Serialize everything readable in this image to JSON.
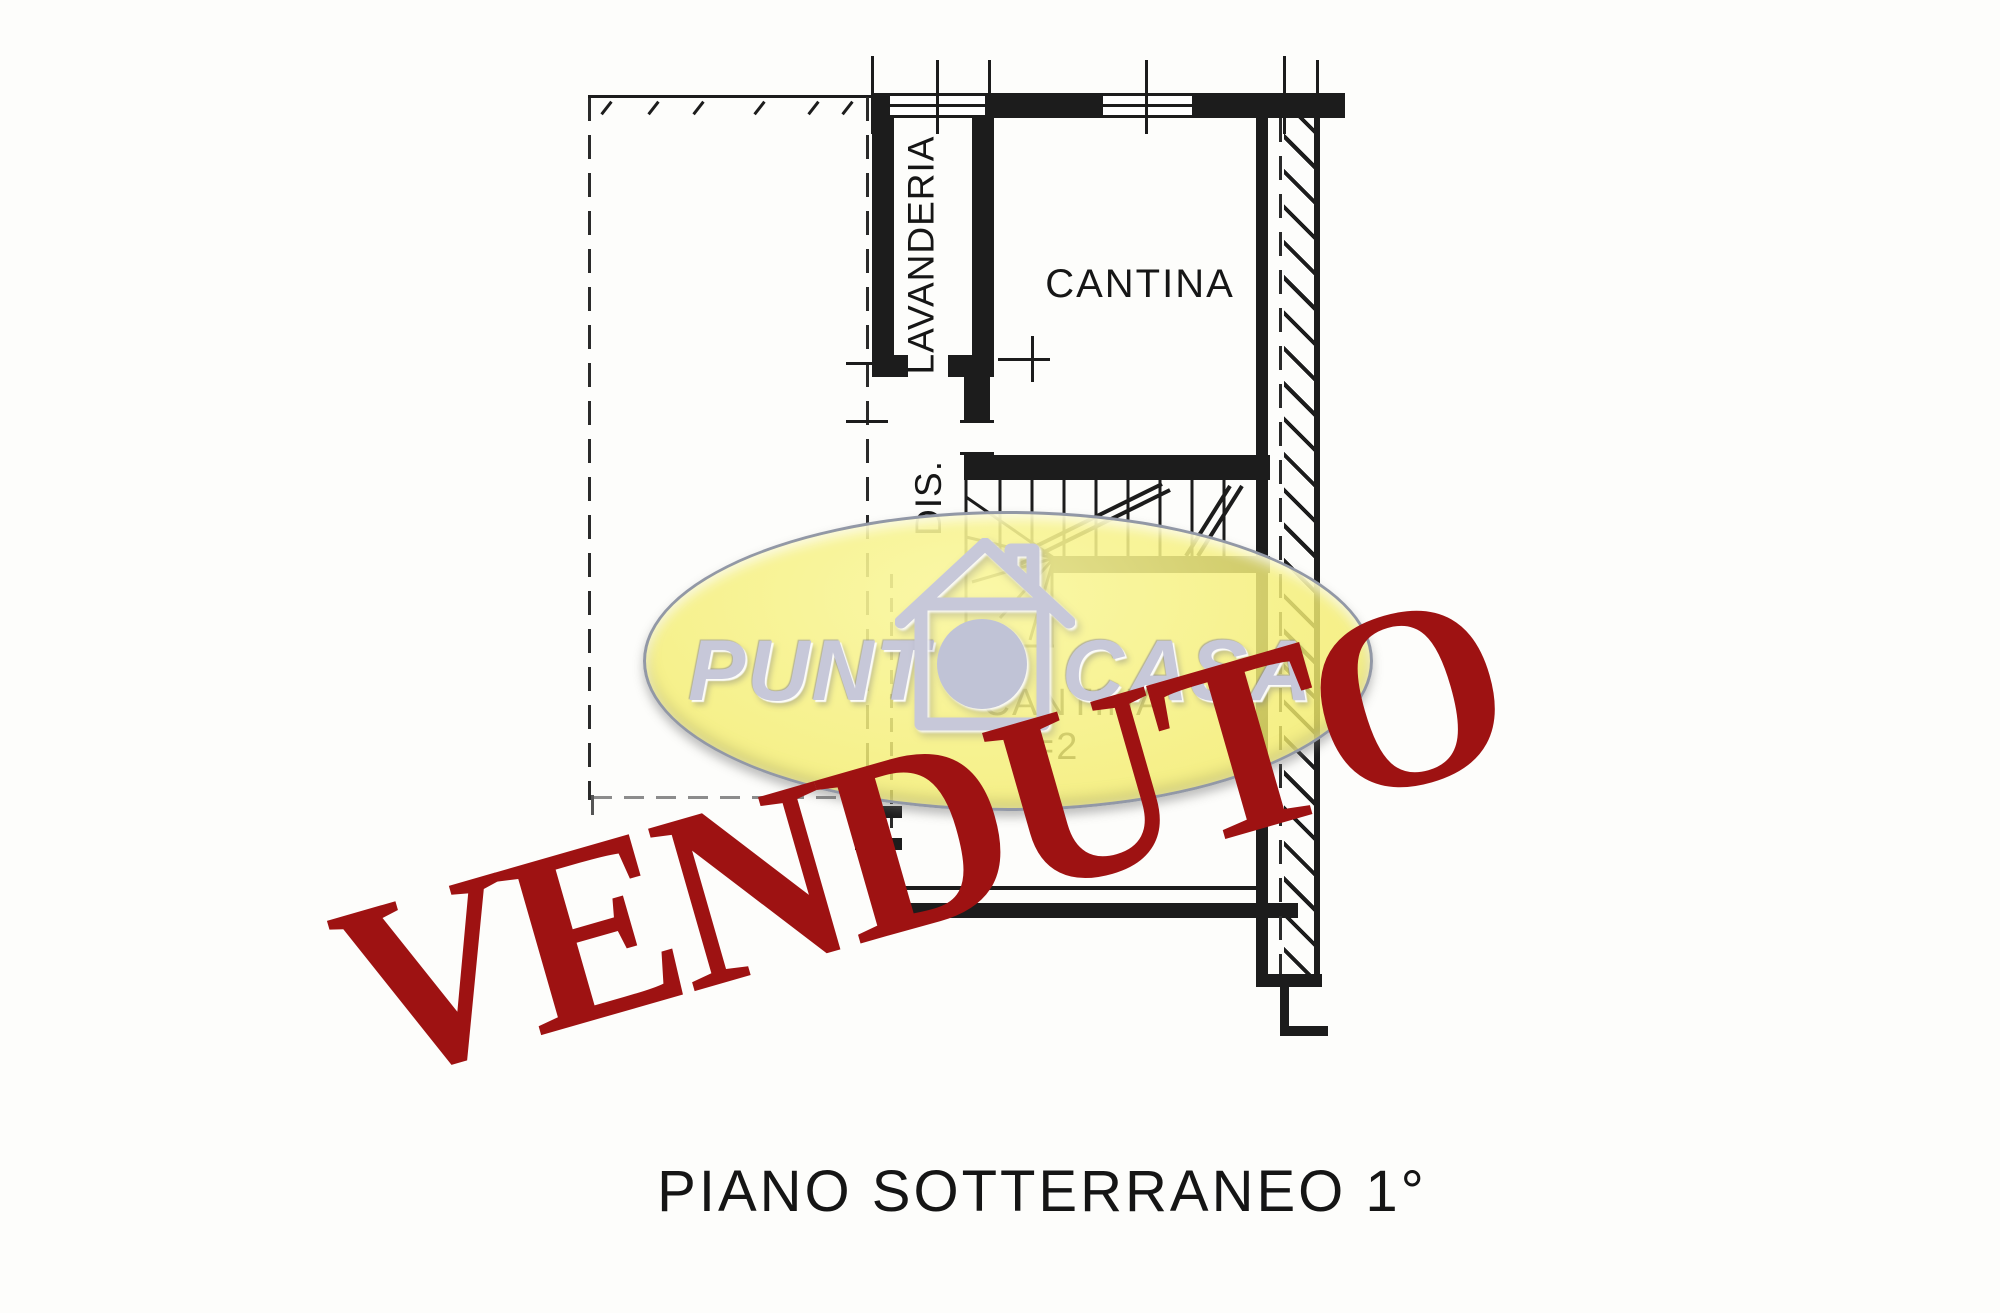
{
  "plan": {
    "line_color": "#1c1c1c",
    "labels": {
      "lavanderia": "LAVANDERIA",
      "dis": "DIS.",
      "cantina_top": "CANTINA",
      "cantina_lower": "CANTINA",
      "height_note": "=2",
      "caption": "PIANO SOTTERRANEO 1°"
    }
  },
  "logo": {
    "brand_left": "PUNT",
    "brand_right": "CASA",
    "icon": "house-dot-icon",
    "colors": {
      "fill": "#f6f07b",
      "border": "#9298a6",
      "text": "#c7c8d9"
    }
  },
  "stamp": {
    "text": "VENDUTO",
    "color": "#9e1212"
  }
}
